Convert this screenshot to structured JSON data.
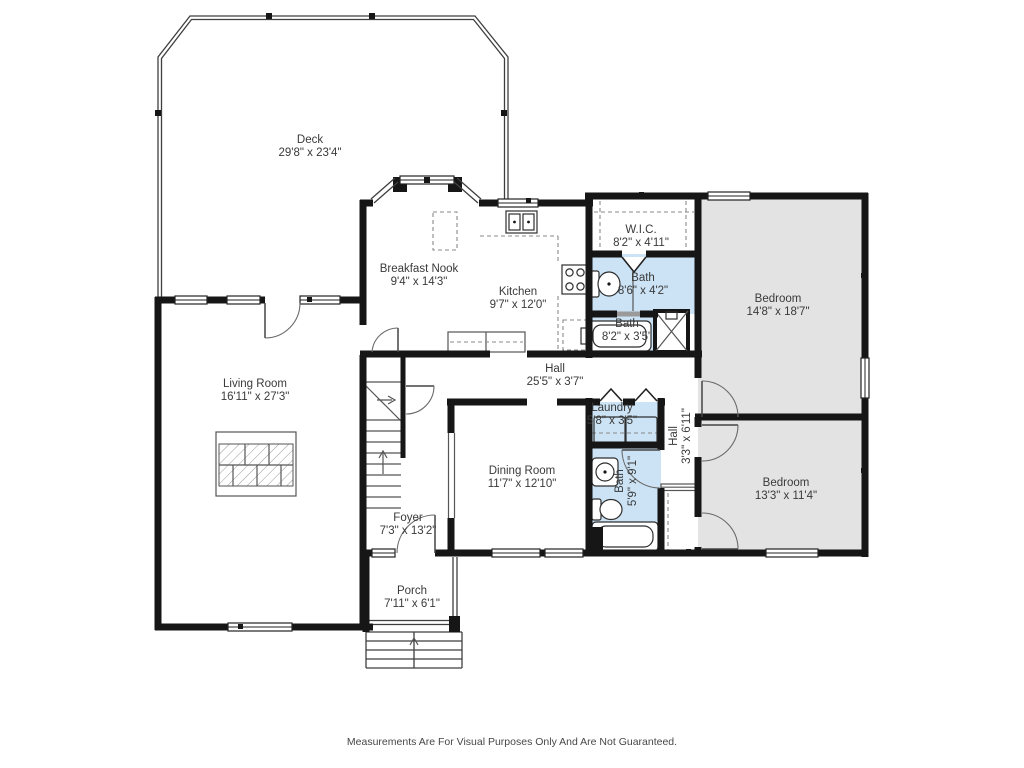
{
  "colors": {
    "wall": "#161616",
    "bath-fill": "#cbe3f4",
    "bedroom-fill": "#e3e3e3",
    "text": "#3a3a3a"
  },
  "rooms": {
    "deck": {
      "name": "Deck",
      "dims": "29'8\" x 23'4\""
    },
    "breakfast_nook": {
      "name": "Breakfast Nook",
      "dims": "9'4\" x 14'3\""
    },
    "kitchen": {
      "name": "Kitchen",
      "dims": "9'7\" x 12'0\""
    },
    "wic": {
      "name": "W.I.C.",
      "dims": "8'2\" x 4'11\""
    },
    "bath_upper": {
      "name": "Bath",
      "dims": "8'6\" x 4'2\""
    },
    "bath_middle": {
      "name": "Bath",
      "dims": "8'2\" x 3'5\""
    },
    "bedroom_primary": {
      "name": "Bedroom",
      "dims": "14'8\" x 18'7\""
    },
    "living_room": {
      "name": "Living Room",
      "dims": "16'11\" x 27'3\""
    },
    "hall_main": {
      "name": "Hall",
      "dims": "25'5\" x 3'7\""
    },
    "laundry": {
      "name": "Laundry",
      "dims": "5'8\" x 3'5\""
    },
    "hall_side": {
      "name": "Hall",
      "dims": "3'3\" x 6'11\""
    },
    "dining_room": {
      "name": "Dining Room",
      "dims": "11'7\" x 12'10\""
    },
    "bath_lower": {
      "name": "Bath",
      "dims": "5'9\" x 9'1\""
    },
    "bedroom_second": {
      "name": "Bedroom",
      "dims": "13'3\" x 11'4\""
    },
    "foyer": {
      "name": "Foyer",
      "dims": "7'3\" x 13'2\""
    },
    "porch": {
      "name": "Porch",
      "dims": "7'11\" x 6'1\""
    }
  },
  "footer": {
    "text": "Measurements Are For Visual Purposes Only And Are Not Guaranteed."
  }
}
